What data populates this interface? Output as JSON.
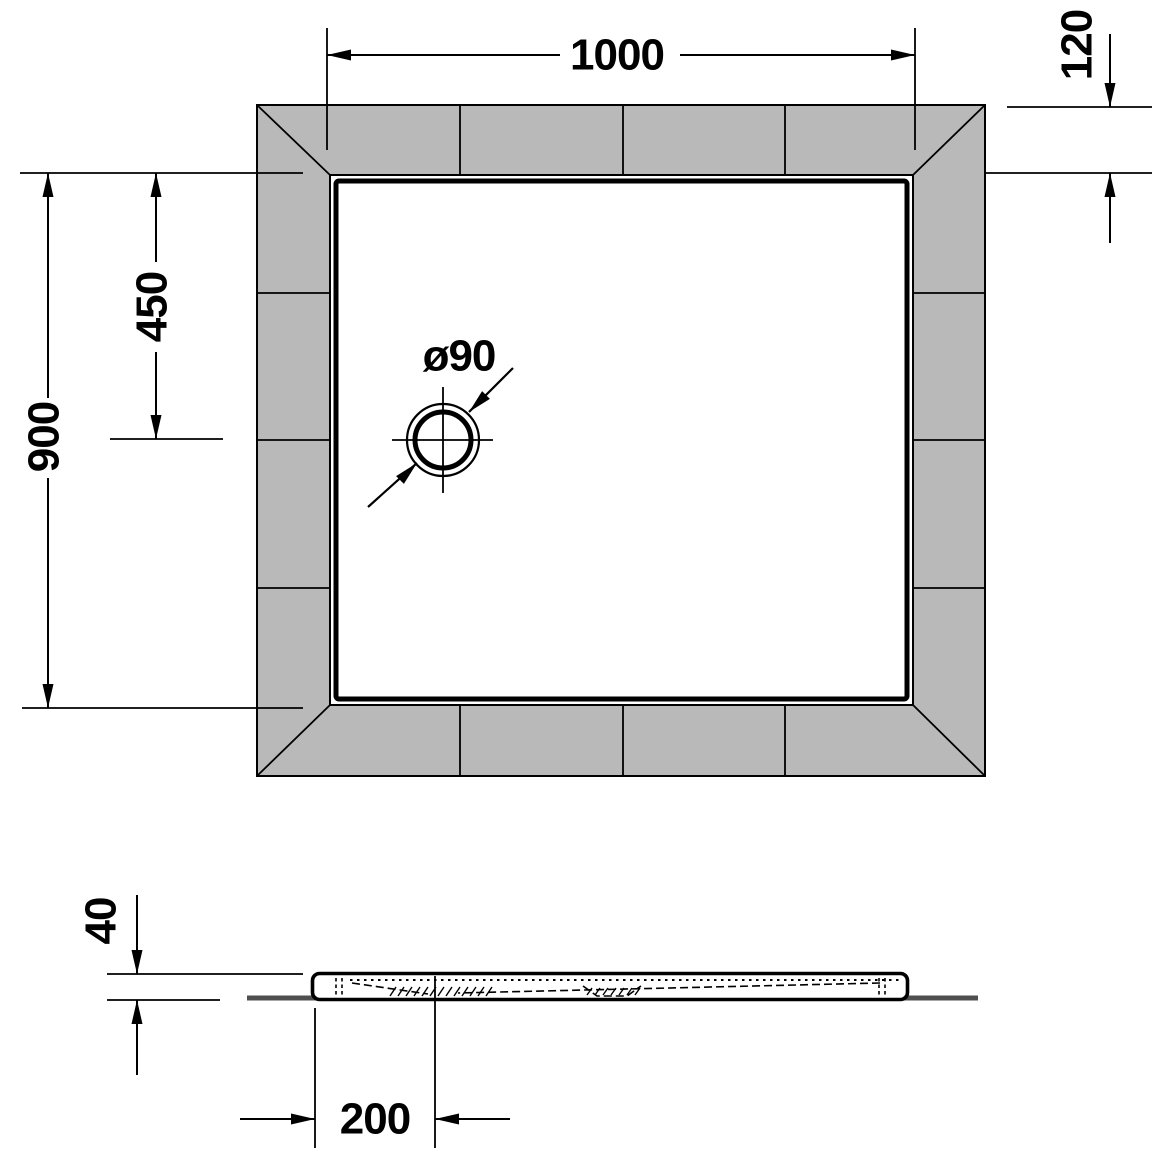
{
  "figure": {
    "colors": {
      "background": "#ffffff",
      "line": "#000000",
      "tile_fill": "#b9b9b9",
      "floor_line": "#4f4f4f"
    },
    "top_view": {
      "dim_width": "1000",
      "dim_tile_border": "120",
      "dim_depth": "900",
      "dim_drain_center": "450",
      "drain_diameter": "ø90"
    },
    "side_view": {
      "dim_height": "40",
      "dim_drain_offset": "200"
    }
  }
}
